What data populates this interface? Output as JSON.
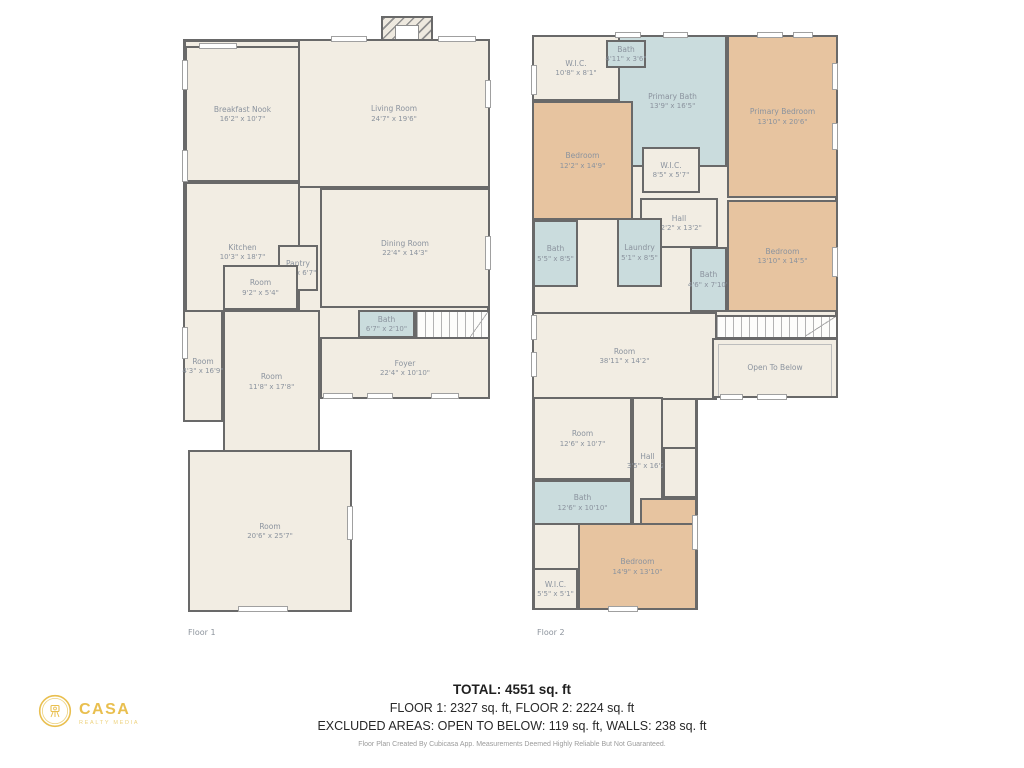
{
  "palette": {
    "wall": "#696969",
    "floor_fill": "#f2ede3",
    "bath_fill": "#cadcdd",
    "bedroom_fill": "#e7c4a0",
    "label_text": "#8b939e",
    "logo_gold": "#e9bf4f"
  },
  "summary": {
    "total": "TOTAL: 4551 sq. ft",
    "floors_line": "FLOOR 1: 2327 sq. ft, FLOOR 2: 2224 sq. ft",
    "excluded_line": "EXCLUDED AREAS: OPEN TO BELOW: 119 sq. ft, WALLS: 238 sq. ft",
    "disclaimer": "Floor Plan Created By Cubicasa App. Measurements Deemed Highly Reliable But Not Guaranteed."
  },
  "logo": {
    "name": "CASA",
    "tagline": "REALTY MEDIA",
    "icon": "camera-tripod-badge-icon"
  },
  "floors": [
    {
      "label": "Floor 1",
      "rooms": [
        {
          "id": "floor1-body",
          "kind": "base",
          "x": 0,
          "y": 25,
          "w": 307,
          "h": 360
        },
        {
          "id": "chimney",
          "kind": "chimney",
          "x": 198,
          "y": 2,
          "w": 52,
          "h": 26
        },
        {
          "id": "breakfast-nook",
          "kind": "floor",
          "x": 2,
          "y": 32,
          "w": 115,
          "h": 136,
          "name": "Breakfast Nook",
          "dims": "16'2\" x 10'7\""
        },
        {
          "id": "kitchen",
          "kind": "floor",
          "x": 2,
          "y": 168,
          "w": 115,
          "h": 140,
          "name": "Kitchen",
          "dims": "10'3\" x 18'7\""
        },
        {
          "id": "living-room",
          "kind": "floor",
          "x": 115,
          "y": 25,
          "w": 192,
          "h": 149,
          "name": "Living Room",
          "dims": "24'7\" x 19'6\""
        },
        {
          "id": "dining-room",
          "kind": "floor",
          "x": 137,
          "y": 174,
          "w": 170,
          "h": 120,
          "name": "Dining Room",
          "dims": "22'4\" x 14'3\""
        },
        {
          "id": "pantry",
          "kind": "floor",
          "x": 95,
          "y": 231,
          "w": 40,
          "h": 46,
          "name": "Pantry",
          "dims": "4'5\" x 6'7\""
        },
        {
          "id": "room-small",
          "kind": "floor",
          "x": 40,
          "y": 251,
          "w": 75,
          "h": 45,
          "name": "Room",
          "dims": "9'2\" x 5'4\""
        },
        {
          "id": "room-narrow",
          "kind": "floor",
          "x": 0,
          "y": 296,
          "w": 40,
          "h": 112,
          "name": "Room",
          "dims": "4'3\" x 16'9\""
        },
        {
          "id": "room-mid",
          "kind": "floor",
          "x": 40,
          "y": 296,
          "w": 97,
          "h": 143,
          "name": "Room",
          "dims": "11'8\" x 17'8\""
        },
        {
          "id": "bath-floor1",
          "kind": "bath",
          "x": 175,
          "y": 296,
          "w": 57,
          "h": 28,
          "name": "Bath",
          "dims": "6'7\" x 2'10\""
        },
        {
          "id": "staircase-floor1",
          "kind": "stairs",
          "x": 232,
          "y": 296,
          "w": 75,
          "h": 30
        },
        {
          "id": "foyer",
          "kind": "floor",
          "x": 137,
          "y": 323,
          "w": 170,
          "h": 62,
          "name": "Foyer",
          "dims": "22'4\" x 10'10\""
        },
        {
          "id": "room-large",
          "kind": "floor",
          "x": 5,
          "y": 436,
          "w": 164,
          "h": 162,
          "name": "Room",
          "dims": "20'6\" x 25'7\""
        }
      ],
      "windows": [
        {
          "x": 16,
          "y": 29,
          "w": 38,
          "h": 6
        },
        {
          "x": 148,
          "y": 22,
          "w": 36,
          "h": 6
        },
        {
          "x": 255,
          "y": 22,
          "w": 38,
          "h": 6
        },
        {
          "x": -1,
          "y": 46,
          "w": 6,
          "h": 30
        },
        {
          "x": -1,
          "y": 136,
          "w": 6,
          "h": 32
        },
        {
          "x": -1,
          "y": 313,
          "w": 6,
          "h": 32
        },
        {
          "x": 302,
          "y": 66,
          "w": 6,
          "h": 28
        },
        {
          "x": 302,
          "y": 222,
          "w": 6,
          "h": 34
        },
        {
          "x": 140,
          "y": 379,
          "w": 30,
          "h": 6
        },
        {
          "x": 184,
          "y": 379,
          "w": 26,
          "h": 6
        },
        {
          "x": 248,
          "y": 379,
          "w": 28,
          "h": 6
        },
        {
          "x": 164,
          "y": 492,
          "w": 6,
          "h": 34
        },
        {
          "x": 55,
          "y": 592,
          "w": 50,
          "h": 6
        }
      ]
    },
    {
      "label": "Floor 2",
      "rooms": [
        {
          "id": "floor2-body-upper",
          "kind": "base",
          "x": 0,
          "y": 5,
          "w": 306,
          "h": 363
        },
        {
          "id": "floor2-body-lower",
          "kind": "base",
          "x": 0,
          "y": 367,
          "w": 166,
          "h": 213
        },
        {
          "id": "wic-top",
          "kind": "floor",
          "x": 0,
          "y": 5,
          "w": 88,
          "h": 66,
          "name": "W.I.C.",
          "dims": "10'8\" x 8'1\""
        },
        {
          "id": "primary-bath",
          "kind": "bath",
          "x": 86,
          "y": 5,
          "w": 109,
          "h": 132,
          "name": "Primary Bath",
          "dims": "13'9\" x 16'5\""
        },
        {
          "id": "bath-top",
          "kind": "bath",
          "x": 74,
          "y": 10,
          "w": 40,
          "h": 28,
          "name": "Bath",
          "dims": "4'11\" x 3'6\""
        },
        {
          "id": "primary-bedroom",
          "kind": "bedroom",
          "x": 195,
          "y": 5,
          "w": 111,
          "h": 163,
          "name": "Primary Bedroom",
          "dims": "13'10\" x 20'6\""
        },
        {
          "id": "bedroom-left",
          "kind": "bedroom",
          "x": 0,
          "y": 71,
          "w": 101,
          "h": 119,
          "name": "Bedroom",
          "dims": "12'2\" x 14'9\""
        },
        {
          "id": "wic-mid",
          "kind": "floor",
          "x": 110,
          "y": 117,
          "w": 58,
          "h": 46,
          "name": "W.I.C.",
          "dims": "8'5\" x 5'7\""
        },
        {
          "id": "hall-upper",
          "kind": "floor",
          "x": 108,
          "y": 168,
          "w": 78,
          "h": 50,
          "name": "Hall",
          "dims": "12'2\" x 13'2\""
        },
        {
          "id": "bath-left",
          "kind": "bath",
          "x": 1,
          "y": 190,
          "w": 45,
          "h": 67,
          "name": "Bath",
          "dims": "5'5\" x 8'5\""
        },
        {
          "id": "laundry",
          "kind": "bath",
          "x": 85,
          "y": 188,
          "w": 45,
          "h": 69,
          "name": "Laundry",
          "dims": "5'1\" x 8'5\""
        },
        {
          "id": "bath-mid",
          "kind": "bath",
          "x": 158,
          "y": 217,
          "w": 37,
          "h": 65,
          "name": "Bath",
          "dims": "4'6\" x 7'10\""
        },
        {
          "id": "bedroom-right",
          "kind": "bedroom",
          "x": 195,
          "y": 170,
          "w": 111,
          "h": 112,
          "name": "Bedroom",
          "dims": "13'10\" x 14'5\""
        },
        {
          "id": "room-38",
          "kind": "floor",
          "x": 0,
          "y": 282,
          "w": 185,
          "h": 88,
          "name": "Room",
          "dims": "38'11\" x 14'2\""
        },
        {
          "id": "staircase-floor2",
          "kind": "stairs",
          "x": 183,
          "y": 285,
          "w": 123,
          "h": 24
        },
        {
          "id": "open-to-below",
          "kind": "open",
          "x": 180,
          "y": 308,
          "w": 126,
          "h": 60,
          "name": "Open To Below"
        },
        {
          "id": "room-bottom",
          "kind": "floor",
          "x": 1,
          "y": 367,
          "w": 99,
          "h": 83,
          "name": "Room",
          "dims": "12'6\" x 10'7\""
        },
        {
          "id": "hall-lower",
          "kind": "floor",
          "x": 100,
          "y": 367,
          "w": 31,
          "h": 128,
          "name": "Hall",
          "dims": "3'5\" x 16'2\""
        },
        {
          "id": "corner-nook",
          "kind": "floor",
          "x": 131,
          "y": 417,
          "w": 34,
          "h": 51
        },
        {
          "id": "bath-bottom",
          "kind": "bath",
          "x": 1,
          "y": 450,
          "w": 99,
          "h": 45,
          "name": "Bath",
          "dims": "12'6\" x 10'10\""
        },
        {
          "id": "bedroom-bottom-upper",
          "kind": "bedroom",
          "x": 108,
          "y": 468,
          "w": 57,
          "h": 30
        },
        {
          "id": "bedroom-bottom",
          "kind": "bedroom",
          "x": 46,
          "y": 493,
          "w": 119,
          "h": 87,
          "name": "Bedroom",
          "dims": "14'9\" x 13'10\""
        },
        {
          "id": "wic-bottom",
          "kind": "floor",
          "x": 1,
          "y": 538,
          "w": 45,
          "h": 42,
          "name": "W.I.C.",
          "dims": "5'5\" x 5'1\""
        }
      ],
      "windows": [
        {
          "x": 83,
          "y": 2,
          "w": 26,
          "h": 6
        },
        {
          "x": 131,
          "y": 2,
          "w": 25,
          "h": 6
        },
        {
          "x": 225,
          "y": 2,
          "w": 26,
          "h": 6
        },
        {
          "x": 261,
          "y": 2,
          "w": 20,
          "h": 6
        },
        {
          "x": 300,
          "y": 33,
          "w": 6,
          "h": 27
        },
        {
          "x": 300,
          "y": 93,
          "w": 6,
          "h": 27
        },
        {
          "x": 300,
          "y": 217,
          "w": 6,
          "h": 30
        },
        {
          "x": -1,
          "y": 35,
          "w": 6,
          "h": 30
        },
        {
          "x": -1,
          "y": 285,
          "w": 6,
          "h": 25
        },
        {
          "x": -1,
          "y": 322,
          "w": 6,
          "h": 25
        },
        {
          "x": 188,
          "y": 364,
          "w": 23,
          "h": 6
        },
        {
          "x": 225,
          "y": 364,
          "w": 30,
          "h": 6
        },
        {
          "x": 160,
          "y": 485,
          "w": 6,
          "h": 35
        },
        {
          "x": 76,
          "y": 576,
          "w": 30,
          "h": 6
        }
      ]
    }
  ]
}
